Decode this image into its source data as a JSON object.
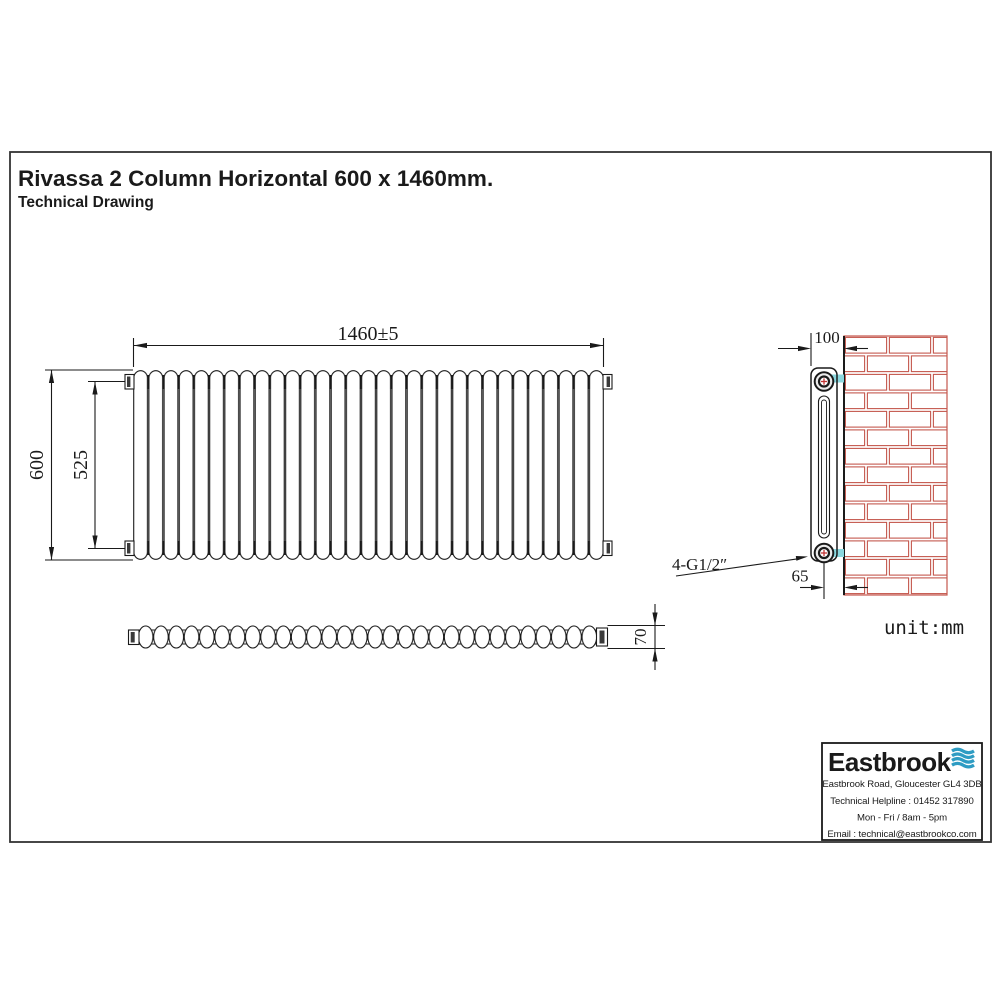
{
  "page": {
    "title": "Rivassa 2 Column Horizontal 600 x 1460mm.",
    "subtitle": "Technical Drawing",
    "unit_label": "unit:mm"
  },
  "dimensions": {
    "overall_width": "1460±5",
    "overall_height": "600",
    "tapping_centres": "525",
    "top_view_depth": "70",
    "wall_face_to_front": "100",
    "wall_to_pipe_centre": "65",
    "connections": "4-G1/2″"
  },
  "footer": {
    "brand": "Eastbrook",
    "address": "Eastbrook Road, Gloucester GL4 3DB",
    "helpline": "Technical Helpline : 01452 317890",
    "hours": "Mon - Fri / 8am - 5pm",
    "email": "Email : technical@eastbrookco.com"
  },
  "colors": {
    "line": "#1a1a1a",
    "brick": "#c4574d",
    "bracket": "#8bd7de",
    "brand_navy": "#1c3a52",
    "brand_blue": "#2e9cc3",
    "fitting_red": "#c23434"
  }
}
